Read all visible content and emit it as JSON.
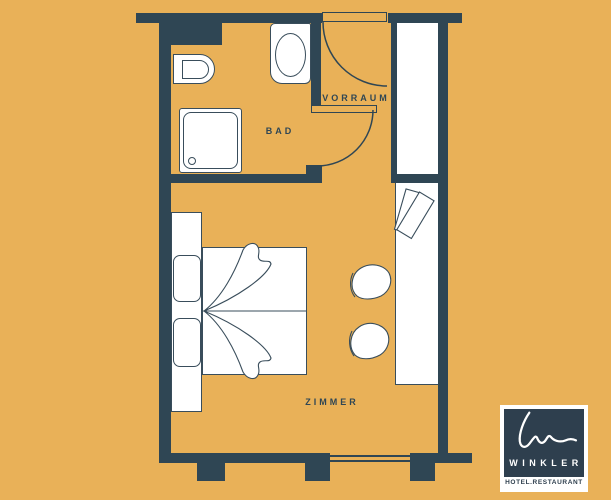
{
  "palette": {
    "background": "#E9B158",
    "wall": "#2F4654",
    "furniture_fill": "#FFFFFF",
    "furniture_line": "#394D5B",
    "logo_background": "#2E3F4E",
    "logo_text": "#FFFFFF"
  },
  "plan": {
    "rooms": [
      {
        "id": "bad",
        "label": "BAD"
      },
      {
        "id": "vorraum",
        "label": "VORRAUM"
      },
      {
        "id": "zimmer",
        "label": "ZIMMER"
      }
    ],
    "furniture": [
      "toilet",
      "sink",
      "shower",
      "entrance-door",
      "bathroom-door",
      "closet",
      "wardrobe-items",
      "double-bed",
      "pillows",
      "blanket",
      "desk-sideboard",
      "chair",
      "chair",
      "window"
    ]
  },
  "logo": {
    "brand": "WINKLER",
    "tagline": "HOTEL.RESTAURANT"
  }
}
